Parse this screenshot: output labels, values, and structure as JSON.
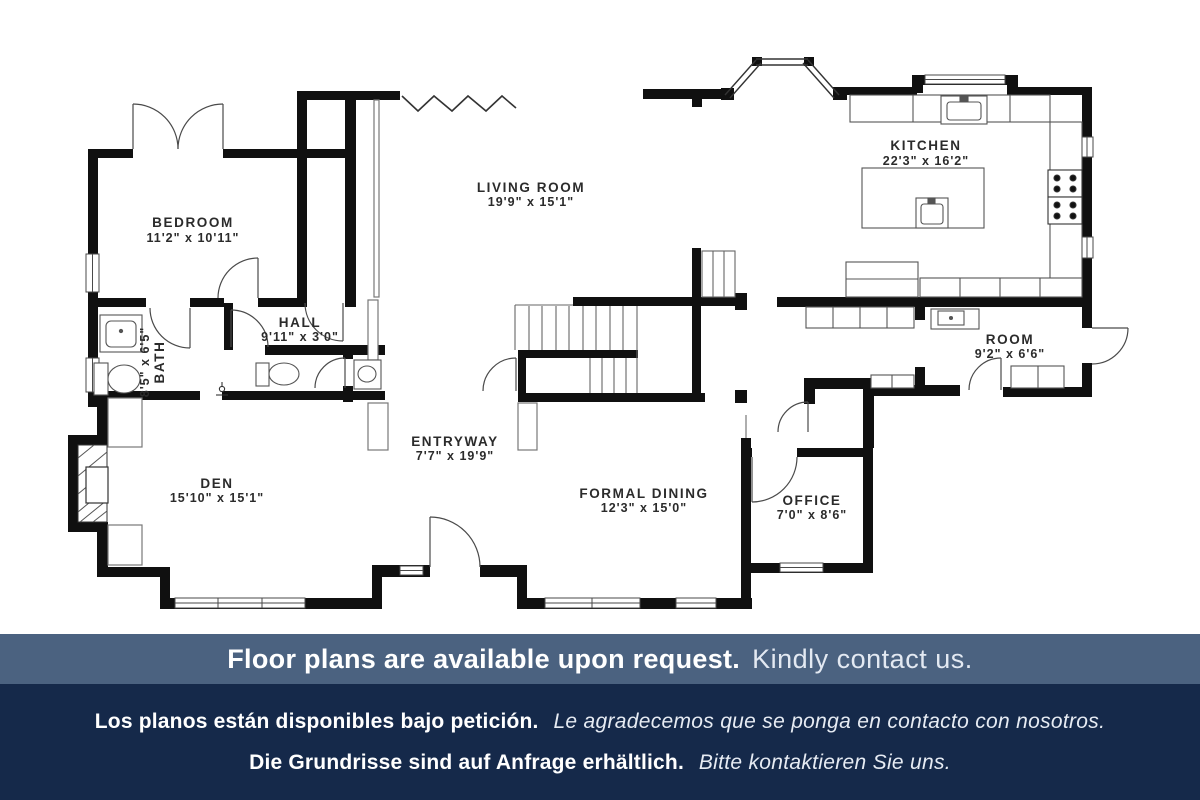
{
  "plan": {
    "rooms": [
      {
        "id": "bedroom",
        "name": "BEDROOM",
        "dims": "11'2\" x 10'11\""
      },
      {
        "id": "living",
        "name": "LIVING ROOM",
        "dims": "19'9\" x 15'1\""
      },
      {
        "id": "kitchen",
        "name": "KITCHEN",
        "dims": "22'3\" x 16'2\""
      },
      {
        "id": "hall",
        "name": "HALL",
        "dims": "9'11\" x 3'0\""
      },
      {
        "id": "bath",
        "name": "BATH",
        "dims": "8'5\" x 6'5\""
      },
      {
        "id": "room",
        "name": "ROOM",
        "dims": "9'2\" x 6'6\""
      },
      {
        "id": "den",
        "name": "DEN",
        "dims": "15'10\" x 15'1\""
      },
      {
        "id": "entryway",
        "name": "ENTRYWAY",
        "dims": "7'7\" x 19'9\""
      },
      {
        "id": "dining",
        "name": "FORMAL DINING",
        "dims": "12'3\" x 15'0\""
      },
      {
        "id": "office",
        "name": "OFFICE",
        "dims": "7'0\" x 8'6\""
      }
    ]
  },
  "banner": {
    "en_bold": "Floor plans are available upon request.",
    "en_regular": "Kindly contact us.",
    "es_bold": "Los planos están disponibles bajo petición.",
    "es_italic": "Le agradecemos que se ponga en contacto con nosotros.",
    "de_bold": "Die Grundrisse sind auf Anfrage erhältlich.",
    "de_italic": "Bitte kontaktieren Sie uns."
  },
  "colors": {
    "wall": "#101010",
    "banner_top_bg": "#4b6280",
    "banner_bottom_bg": "#15294a",
    "text_light": "#ffffff",
    "plan_text": "#2b2b2b"
  }
}
